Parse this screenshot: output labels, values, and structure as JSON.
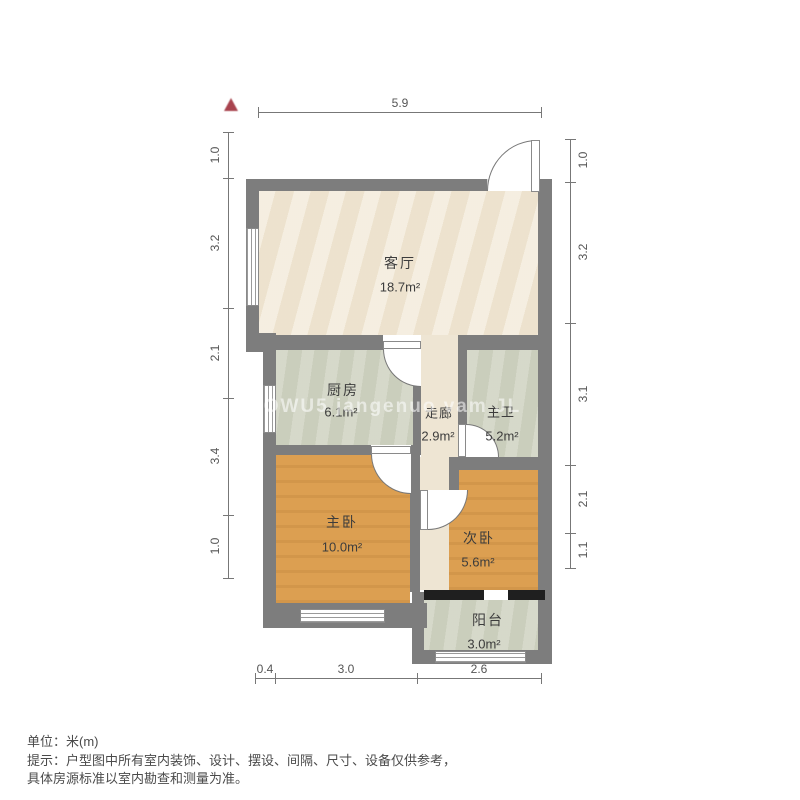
{
  "plan": {
    "rooms": {
      "living": {
        "name": "客厅",
        "area": "18.7m²"
      },
      "kitchen": {
        "name": "厨房",
        "area": "6.1m²"
      },
      "corridor": {
        "name": "走廊",
        "area": "2.9m²"
      },
      "bath": {
        "name": "主卫",
        "area": "5.2m²"
      },
      "master": {
        "name": "主卧",
        "area": "10.0m²"
      },
      "second": {
        "name": "次卧",
        "area": "5.6m²"
      },
      "balcony": {
        "name": "阳台",
        "area": "3.0m²"
      }
    },
    "dims": {
      "top": [
        "5.9"
      ],
      "left": [
        "1.0",
        "3.2",
        "2.1",
        "3.4",
        "1.0"
      ],
      "right": [
        "1.0",
        "3.2",
        "3.1",
        "2.1",
        "1.1"
      ],
      "bottom": [
        "0.4",
        "3.0",
        "2.6"
      ]
    },
    "watermark": "HOWU5 jangenuo vam JL",
    "colors": {
      "wall": "#7d7d7d",
      "living_floor": "#f1e8d5",
      "service_floor": "#cfd2c1",
      "bedroom_floor": "#dc9f51",
      "north_arrow": "#a8434e"
    }
  },
  "footer": {
    "unit_label": "单位：米(m)",
    "note_line1": "提示：户型图中所有室内装饰、设计、摆设、间隔、尺寸、设备仅供参考，",
    "note_line2": "具体房源标准以室内勘查和测量为准。"
  }
}
